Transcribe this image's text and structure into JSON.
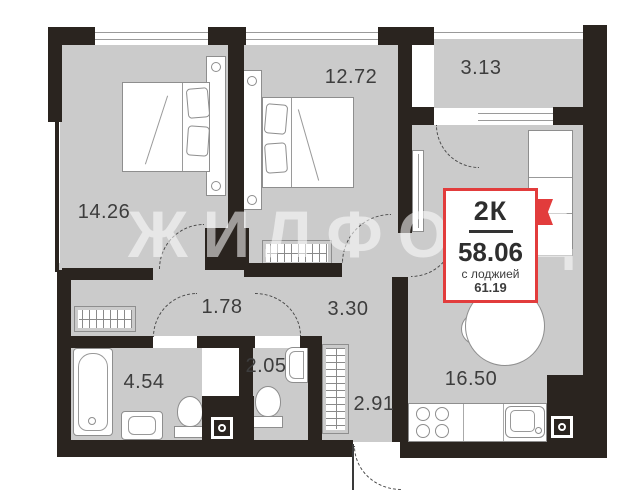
{
  "watermark": "ЖИЛФОНД",
  "badge": {
    "rooms": "2К",
    "area": "58.06",
    "note": "с лоджией",
    "area_with_loggia": "61.19"
  },
  "rooms": {
    "bedroom_1": "14.26",
    "bedroom_2": "12.72",
    "loggia": "3.13",
    "hallway": "1.78",
    "corridor": "3.30",
    "bathroom": "4.54",
    "wc": "2.05",
    "entry_hall": "2.91",
    "kitchen_living": "16.50"
  },
  "colors": {
    "wall": "#2a241f",
    "floor": "#cbcbcb",
    "accent": "#e23c3c",
    "label_text": "#3d3d3d"
  }
}
